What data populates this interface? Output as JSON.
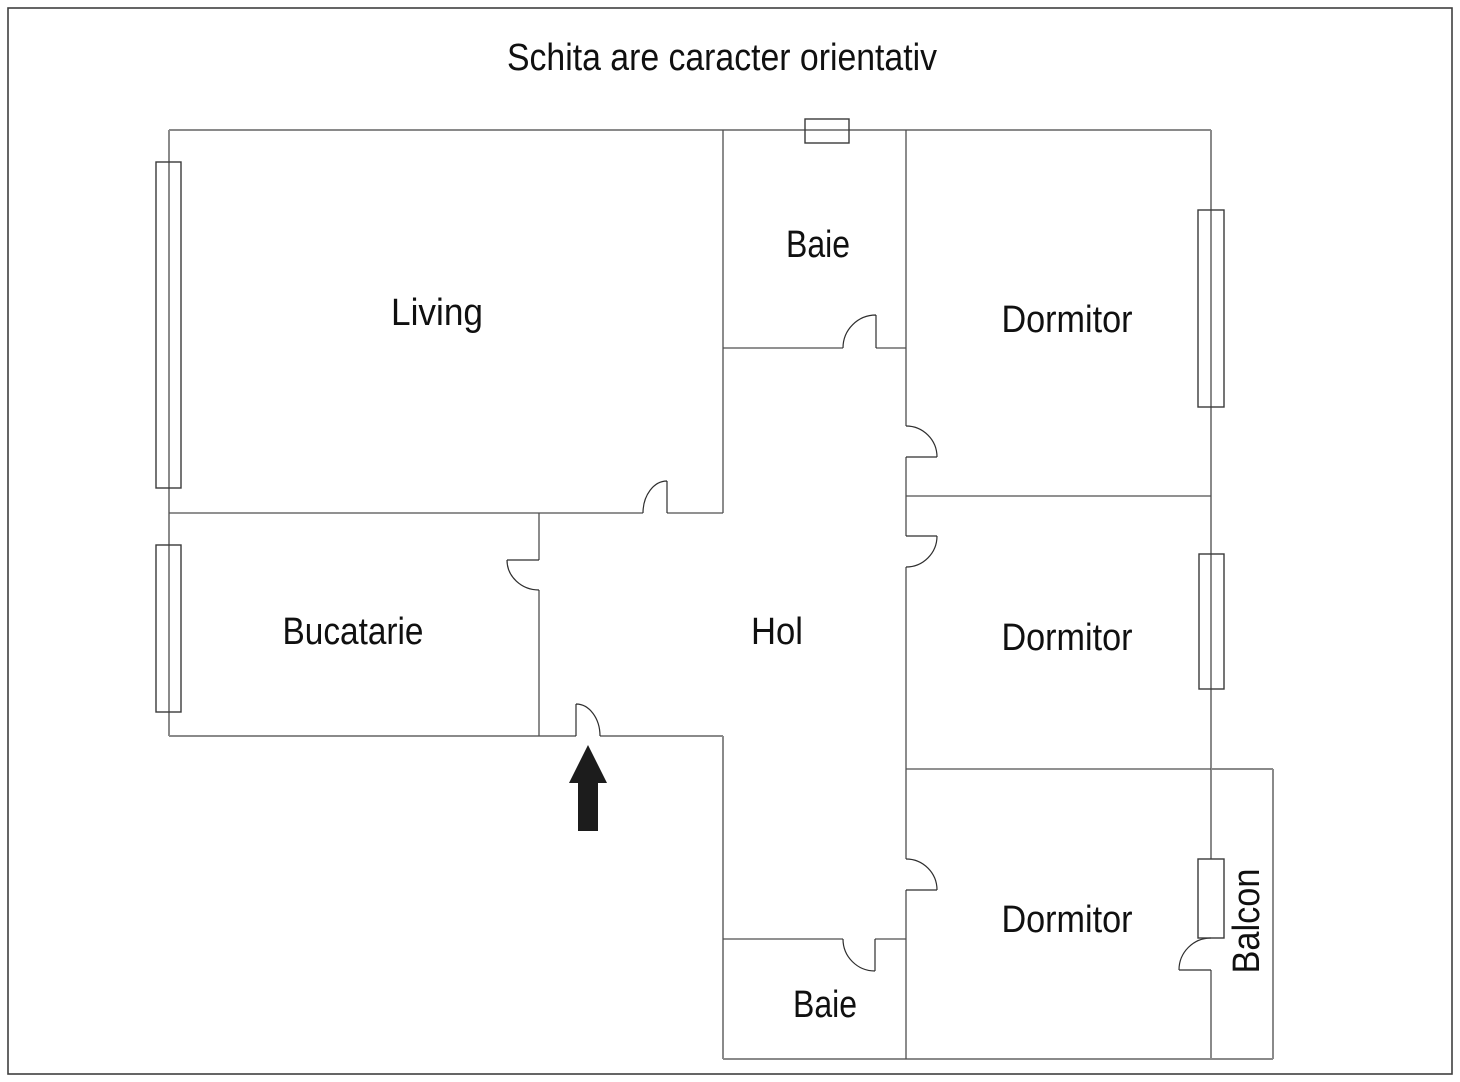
{
  "title": "Schita are caracter orientativ",
  "rooms": {
    "living": {
      "label": "Living"
    },
    "baie_top": {
      "label": "Baie"
    },
    "dormitor_top": {
      "label": "Dormitor"
    },
    "bucatarie": {
      "label": "Bucatarie"
    },
    "hol": {
      "label": "Hol"
    },
    "dormitor_middle": {
      "label": "Dormitor"
    },
    "dormitor_bottom": {
      "label": "Dormitor"
    },
    "baie_bottom": {
      "label": "Baie"
    },
    "balcon": {
      "label": "Balcon"
    }
  },
  "symbols": {
    "entrance_arrow": "up-arrow"
  },
  "colors": {
    "background": "#ffffff",
    "outer_wall": "#8a8a8a",
    "inner_wall": "#4f4f4f",
    "door": "#2e2e2e",
    "window": "#3a3a3a",
    "text": "#101010",
    "arrow": "#1c1c1c",
    "border": "#3f3f3f"
  }
}
